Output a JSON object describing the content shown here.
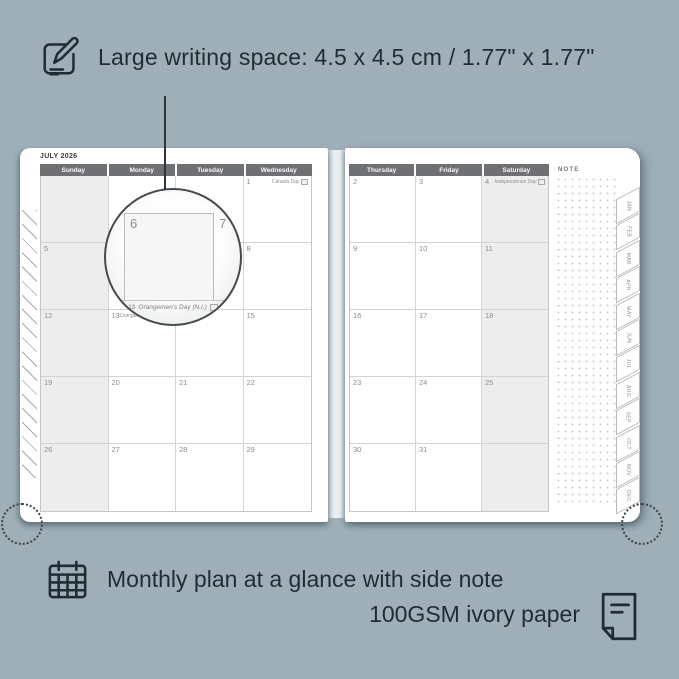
{
  "top_note": {
    "text": "Large writing space: 4.5 x 4.5 cm / 1.77\" x 1.77\""
  },
  "bottom_note": {
    "line1": "Monthly plan at a glance with side note",
    "line2": "100GSM ivory paper"
  },
  "calendar": {
    "title": "JULY 2026",
    "note_label": "NOTE",
    "weekdays_left": [
      "Sunday",
      "Monday",
      "Tuesday",
      "Wednesday"
    ],
    "weekdays_right": [
      "Thursday",
      "Friday",
      "Saturday"
    ],
    "left_cells": [
      {
        "d": ""
      },
      {
        "d": ""
      },
      {
        "d": ""
      },
      {
        "d": "1",
        "h": "Canada Day"
      },
      {
        "d": "5"
      },
      {
        "d": "6"
      },
      {
        "d": "7"
      },
      {
        "d": "8"
      },
      {
        "d": "12"
      },
      {
        "d": "13",
        "h": "Orangemen's Day (N.I.)"
      },
      {
        "d": "14"
      },
      {
        "d": "15"
      },
      {
        "d": "19"
      },
      {
        "d": "20"
      },
      {
        "d": "21"
      },
      {
        "d": "22"
      },
      {
        "d": "26"
      },
      {
        "d": "27"
      },
      {
        "d": "28"
      },
      {
        "d": "29"
      }
    ],
    "right_cells": [
      {
        "d": "2"
      },
      {
        "d": "3"
      },
      {
        "d": "4",
        "h": "Independence Day"
      },
      {
        "d": "9"
      },
      {
        "d": "10"
      },
      {
        "d": "11"
      },
      {
        "d": "16"
      },
      {
        "d": "17"
      },
      {
        "d": "18"
      },
      {
        "d": "23"
      },
      {
        "d": "24"
      },
      {
        "d": "25"
      },
      {
        "d": "30"
      },
      {
        "d": "31"
      },
      {
        "d": ""
      }
    ],
    "month_tabs": [
      "JAN",
      "FEB",
      "MAR",
      "APR",
      "MAY",
      "JUN",
      "JUL",
      "AUG",
      "SEP",
      "OCT",
      "NOV",
      "DEC"
    ],
    "magnifier": {
      "day": "6",
      "adjacent_day": "7",
      "holiday_day": "13",
      "holiday": "Orangemen's Day (N.I.)"
    }
  },
  "colors": {
    "background": "#9EAFB8",
    "ink": "#1F2C35",
    "header_bar": "#6F7073",
    "shaded_column": "#EDEDED",
    "page": "#FFFFFF"
  }
}
